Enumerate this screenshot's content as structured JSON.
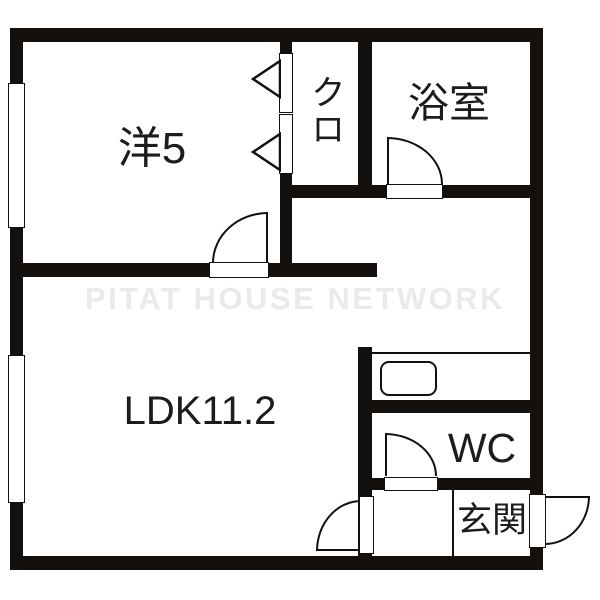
{
  "watermark": "PITAT HOUSE NETWORK",
  "rooms": {
    "western": {
      "label": "洋5"
    },
    "closet": {
      "label": "クロ"
    },
    "bathroom": {
      "label": "浴室"
    },
    "ldk": {
      "label": "LDK11.2"
    },
    "wc": {
      "label": "WC"
    },
    "entrance": {
      "label": "玄関"
    }
  },
  "colors": {
    "wall": "#14100d",
    "text": "#1c1c1c",
    "watermark": "#eaeaea",
    "background": "#ffffff"
  }
}
